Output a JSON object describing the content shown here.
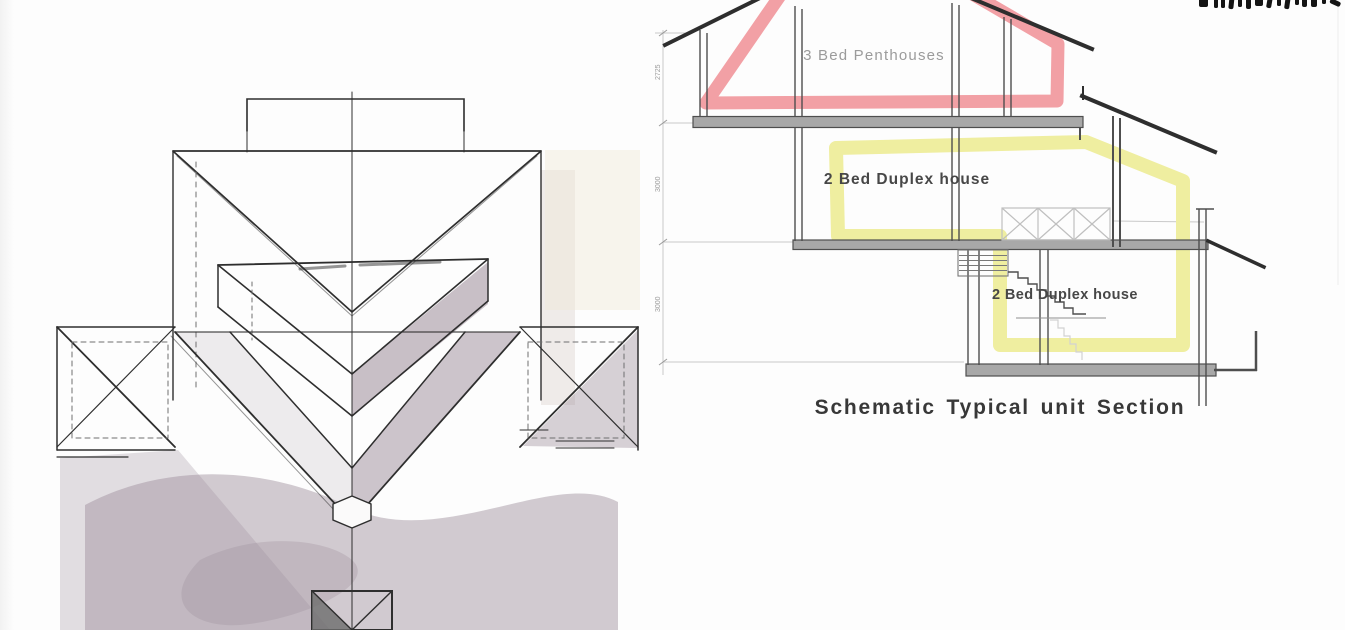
{
  "page": {
    "background": "#FDFDFD"
  },
  "colors": {
    "pink": "#F2A0A5",
    "yellow": "#EFEEA0",
    "slab": "#A8A8A8",
    "wall": "#4E4E4E",
    "ink": "#2E2E2E",
    "light": "#C9C9C9",
    "mauve": "#9C8C99",
    "label_grey": "#9B9B9B",
    "label_dark": "#474747",
    "caption": "#383838",
    "fragment": "#141414"
  },
  "section": {
    "labels": {
      "penthouse": "3 Bed Penthouses",
      "duplex_upper": "2 Bed Duplex house",
      "duplex_lower": "2 Bed Duplex house"
    },
    "caption": "Schematic Typical unit Section",
    "dimensions": [
      "2725",
      "3000",
      "3000"
    ]
  }
}
